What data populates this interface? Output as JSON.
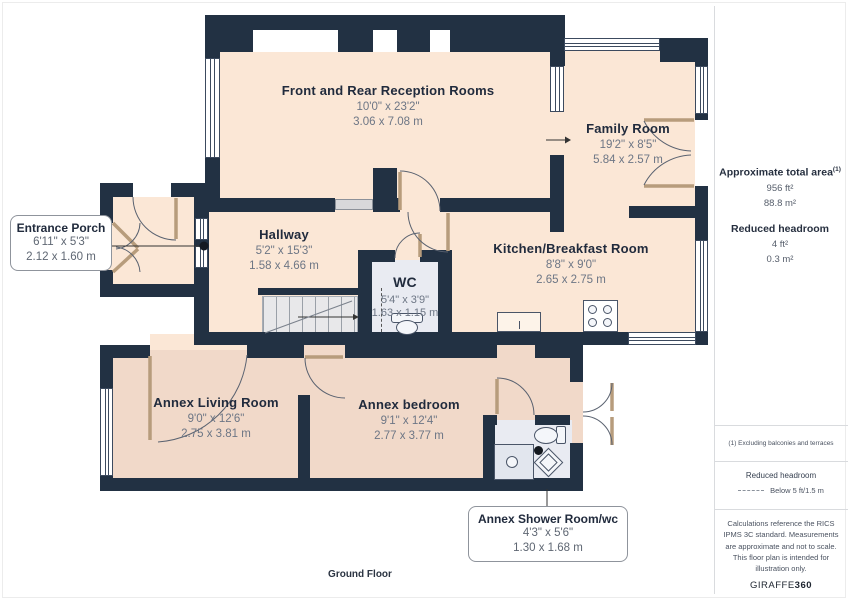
{
  "floor_label": "Ground Floor",
  "rooms": {
    "reception": {
      "name": "Front and Rear Reception Rooms",
      "imperial": "10'0\" x 23'2\"",
      "metric": "3.06 x 7.08 m"
    },
    "family": {
      "name": "Family Room",
      "imperial": "19'2\" x 8'5\"",
      "metric": "5.84 x 2.57 m"
    },
    "porch": {
      "name": "Entrance Porch",
      "imperial": "6'11\" x 5'3\"",
      "metric": "2.12 x 1.60 m"
    },
    "hallway": {
      "name": "Hallway",
      "imperial": "5'2\" x 15'3\"",
      "metric": "1.58 x 4.66 m"
    },
    "wc": {
      "name": "WC",
      "imperial": "5'4\" x 3'9\"",
      "metric": "1.63 x 1.15 m"
    },
    "kitchen": {
      "name": "Kitchen/Breakfast Room",
      "imperial": "8'8\" x 9'0\"",
      "metric": "2.65 x 2.75 m"
    },
    "annex_living": {
      "name": "Annex Living Room",
      "imperial": "9'0\" x 12'6\"",
      "metric": "2.75 x 3.81 m"
    },
    "annex_bedroom": {
      "name": "Annex bedroom",
      "imperial": "9'1\" x 12'4\"",
      "metric": "2.77 x 3.77 m"
    },
    "annex_shower": {
      "name": "Annex Shower Room/wc",
      "imperial": "4'3\" x 5'6\"",
      "metric": "1.30 x 1.68 m"
    }
  },
  "sidebar": {
    "total_area_label": "Approximate total area",
    "total_area_sup": "(1)",
    "total_area_ft": "956 ft²",
    "total_area_m": "88.8 m²",
    "reduced_headroom_label": "Reduced headroom",
    "reduced_headroom_ft": "4 ft²",
    "reduced_headroom_m": "0.3 m²",
    "footnote": "(1) Excluding balconies and terraces",
    "legend_title": "Reduced headroom",
    "legend_value": "Below 5 ft/1.5 m",
    "disclaimer": "Calculations reference the RICS IPMS 3C standard. Measurements are approximate and not to scale. This floor plan is intended for illustration only.",
    "brand_regular": "GIRAFFE",
    "brand_bold": "360"
  },
  "colors": {
    "wall": "#223143",
    "room_main": "#fbe7d6",
    "room_annex": "#f1d9c9",
    "wet_room": "#e9ebf2",
    "stairs": "#e8e8ea",
    "room_name_text": "#212b3d",
    "dimension_text": "#6d7685"
  }
}
